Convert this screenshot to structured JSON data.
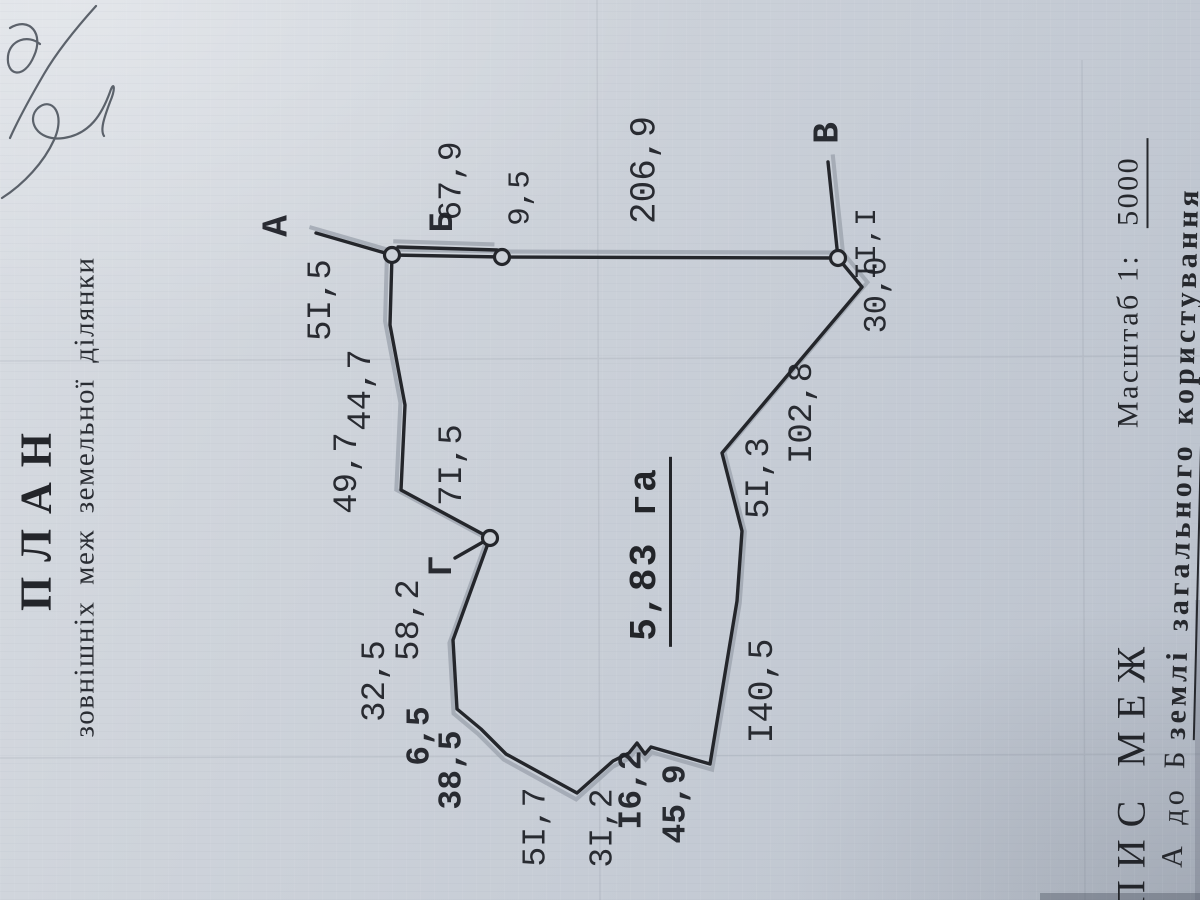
{
  "document": {
    "title": "П Л А Н",
    "subtitle": "зовнішніх меж земельної ділянки",
    "area_value": "5,83 га",
    "footer_heading": "ПИС  МЕЖ",
    "scale_label": "Масштаб 1:",
    "scale_value": "5000",
    "legend_plain": "А до Б",
    "legend_bold": "землі загального користування"
  },
  "colors": {
    "paper": "#ccd1d8",
    "ink": "#24262b",
    "shadow": "#99a0aa",
    "pen": "#3f4650"
  },
  "plan_labels": [
    {
      "t": "А",
      "x": 277,
      "y": 226,
      "s": 36,
      "b": true
    },
    {
      "t": "Б",
      "x": 444,
      "y": 222,
      "s": 34,
      "b": true
    },
    {
      "t": "В",
      "x": 828,
      "y": 133,
      "s": 36,
      "b": true
    },
    {
      "t": "Г",
      "x": 443,
      "y": 566,
      "s": 34,
      "b": true
    },
    {
      "t": "5I,5",
      "x": 322,
      "y": 300,
      "s": 34
    },
    {
      "t": "49,7",
      "x": 348,
      "y": 473,
      "s": 34
    },
    {
      "t": "44,7",
      "x": 362,
      "y": 390,
      "s": 34
    },
    {
      "t": "7I,5",
      "x": 453,
      "y": 465,
      "s": 34
    },
    {
      "t": "67,9",
      "x": 452,
      "y": 181,
      "s": 33
    },
    {
      "t": "9,5",
      "x": 521,
      "y": 198,
      "s": 31
    },
    {
      "t": "206,9",
      "x": 645,
      "y": 170,
      "s": 36
    },
    {
      "t": "II,I",
      "x": 868,
      "y": 244,
      "s": 30
    },
    {
      "t": "30,0",
      "x": 877,
      "y": 295,
      "s": 32
    },
    {
      "t": "I02,8",
      "x": 803,
      "y": 413,
      "s": 34
    },
    {
      "t": "5I,3",
      "x": 760,
      "y": 478,
      "s": 34
    },
    {
      "t": "I40,5",
      "x": 763,
      "y": 691,
      "s": 35
    },
    {
      "t": "45,9",
      "x": 676,
      "y": 804,
      "s": 33,
      "b": true
    },
    {
      "t": "I6,2",
      "x": 632,
      "y": 790,
      "s": 33,
      "b": true
    },
    {
      "t": "3I,2",
      "x": 603,
      "y": 828,
      "s": 33
    },
    {
      "t": "5I,7",
      "x": 536,
      "y": 827,
      "s": 33
    },
    {
      "t": "38,5",
      "x": 452,
      "y": 770,
      "s": 33,
      "b": true
    },
    {
      "t": "6,5",
      "x": 420,
      "y": 736,
      "s": 33,
      "b": true
    },
    {
      "t": "32,5",
      "x": 376,
      "y": 681,
      "s": 34
    },
    {
      "t": "58,2",
      "x": 410,
      "y": 620,
      "s": 34
    }
  ],
  "plan_geometry": {
    "boundary": "316,233 392,255 390,325 405,405 401,490 490,538 453,640 457,709 481,729 506,754 577,793 613,761 629,753 637,743 645,754 651,747 710,764 737,601 742,531 722,453 862,287 838,258 502,257 392,255",
    "road_rail": "398,247 497,250",
    "v_spur": "838,258 828,162",
    "g_spur": "490,538 455,558",
    "nodes": [
      [
        392,
        255
      ],
      [
        502,
        257
      ],
      [
        490,
        538
      ],
      [
        838,
        258
      ]
    ]
  }
}
